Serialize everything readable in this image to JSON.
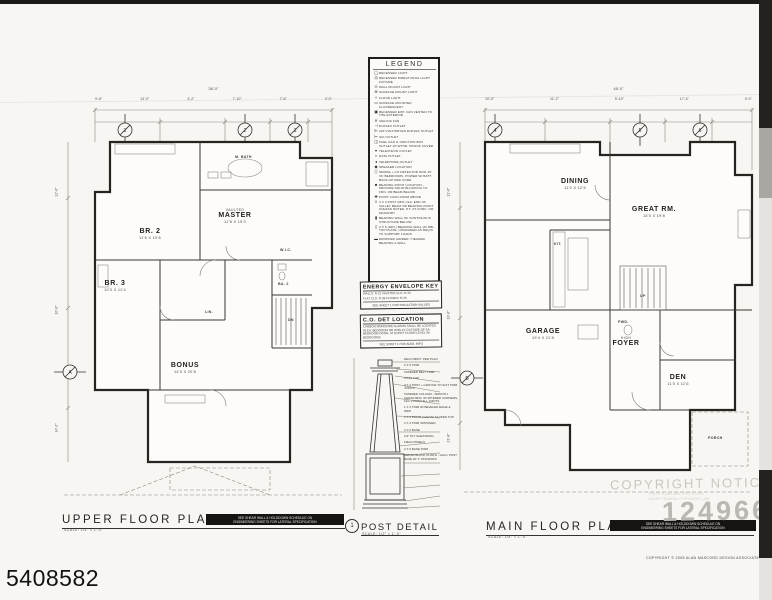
{
  "page": {
    "photo_id": "5408582",
    "watermark_notice": "COPYRIGHT NOTICE",
    "watermark_sub1": "THESE PLANS ARE PROTECTED",
    "watermark_sub2": "UNDER FEDERAL COPYRIGHT LAW",
    "watermark_number": "124966",
    "copyright_line": "COPYRIGHT © 2008 ALAN MASCORD DESIGN ASSOCIATES INC."
  },
  "notices": {
    "line1": "SEE SHEAR WALL & HOLDDOWN SCHEDULE ON",
    "line2": "ENGINEERING SHEETS FOR LATERAL SPECIFICATION"
  },
  "legend": {
    "title": "LEGEND",
    "items": [
      {
        "s": "◯",
        "t": "RECESSED LIGHT"
      },
      {
        "s": "◎",
        "t": "RECESSED DIRECTIONAL LIGHT FIXTURE"
      },
      {
        "s": "⊙",
        "t": "WALL MOUNT LIGHT"
      },
      {
        "s": "⊕",
        "t": "SURFACE MOUNT LIGHT"
      },
      {
        "s": "✧",
        "t": "FLOOD LIGHT"
      },
      {
        "s": "▭",
        "t": "SURFACE MOUNTED FLUORESCENT"
      },
      {
        "s": "▣",
        "t": "RECESSED EXH. FAN VENTED TO THE EXTERIOR"
      },
      {
        "s": "✕",
        "t": "CEILING FAN"
      },
      {
        "s": "⊣",
        "t": "DUPLEX OUTLET"
      },
      {
        "s": "⊫",
        "t": "220 VOLT/DRYER DUPLEX OUTLET"
      },
      {
        "s": "⊢",
        "t": "GFI OUTLET"
      },
      {
        "s": "◫",
        "t": "FUEL GAS & JUNCTION BOX OUTLET W/ WTHR. PROOF COVER"
      },
      {
        "s": "▾",
        "t": "TELEVISION OUTLET"
      },
      {
        "s": "▿",
        "t": "DATA OUTLET"
      },
      {
        "s": "◂",
        "t": "TELEPHONE OUTLET"
      },
      {
        "s": "◆",
        "t": "SPEAKER LOCATION"
      },
      {
        "s": "ⓢ",
        "t": "SMOKE + CO DETECTOR W/IN 15' OF BEDROOMS, POWER W/ BATT. BACK-UP PER CODE"
      },
      {
        "s": "■",
        "t": "BEARING POINT LOCATION - PROVIDE SOLID BLOCKING TO FDN. OR BEAM BELOW"
      },
      {
        "s": "✚",
        "t": "POINT LOAD FROM ABOVE"
      },
      {
        "s": "‖",
        "t": "4 X 4 POST (MIN.) EA. END OF VALLEY BEAM OR BEARING POINT UNLESS NOTED, P.T. AT CONC. OR MASONRY"
      },
      {
        "s": "▮",
        "t": "BEARING WALL W/ CONTINUOUS STRUCTURE BELOW"
      },
      {
        "s": "▯",
        "t": "2 X 6 (MIN.) BEARING WALL W/ DBL. TOP PLATE, UPGRADED AS REQ'D TO SUPPORT LOADS"
      },
      {
        "s": "▬",
        "t": "DROPPED GIRDER / HEADER BEARING A WALL"
      }
    ]
  },
  "energy_key": {
    "title": "ENERGY ENVELOPE KEY",
    "line1": "WALLS: R-21      VAULTED CLG: R-30",
    "line2": "FLAT CLG: R-38   FLOORS: R-25",
    "footer": "SEE SHEET 1 FOR INSULATION VALUES"
  },
  "co_det": {
    "title": "C.O. DET LOCATION",
    "body": "CARBON MONOXIDE ALARMS SHALL BE LOCATED IN EA. BEDROOM OR W/IN 15' OUTSIDE OF EA. BEDROOM DOOR, AT EVERY FLOOR LEVEL W/ BEDROOMS",
    "footer": "SEE SHEET 1 FOR ADD'L INFO"
  },
  "post_detail": {
    "bubble": "1",
    "title": "POST DETAIL",
    "scale": "SCALE: 1/2\" = 1'-0\"",
    "callouts": [
      "DECO BRKT. PER PLAN",
      "2 X 6 TRIM",
      "TAPERED BELT TRIM",
      "POST CAP",
      "4 X 4 POST + GROOVE TO SUIT TRIM JOINTS",
      "TAPERED COLUMN - SMOOTH CEDAR BDS. W/ MITERED CORNERS, FILL + PAINT ALL JOINTS",
      "1 X 4 TRIM W/ BEVELED EDGE & DRIP",
      "2 X 6 PLINTH CAP W/ SLOPED TOP",
      "2 X 4 TRIM 'APRONED'",
      "2 X 6 BASE",
      "1/2\" PLY SHEATHING",
      "FIELD PANELS",
      "2 X 6 BASE TRIM",
      "CEDAR BLOCK PLINTH - GALV. POST BASE W/ 1\" STANDOFF"
    ]
  },
  "upper_plan": {
    "title": "UPPER FLOOR PLAN",
    "scale": "SCALE: 1/4\" = 1'-0\"",
    "overall_dim": "38'-0\"",
    "dims_top": [
      "9'-6\"",
      "13'-0\"",
      "4'-2\"",
      "7'-10\"",
      "7'-6\"",
      "3'-0\""
    ],
    "dims_left": [
      "12'-6\"",
      "10'-0\"",
      "14'-2\""
    ],
    "grid_bubbles": [
      "1",
      "2",
      "3"
    ],
    "side_bubble": "A",
    "rooms": {
      "br2": {
        "name": "BR. 2",
        "dims": "11'6 X 10'8"
      },
      "master": {
        "sub": "VAULTED",
        "name": "MASTER",
        "dims": "12'6 X 15'0"
      },
      "br3": {
        "name": "BR. 3",
        "dims": "10'0 X 11'4"
      },
      "bonus": {
        "name": "BONUS",
        "dims": "14'0 X 20'8"
      }
    },
    "small_labels": {
      "mba": "M. BATH",
      "wic": "W.I.C.",
      "ba2": "BA. 2",
      "lin": "LIN.",
      "dn": "DN"
    }
  },
  "main_plan": {
    "title": "MAIN FLOOR PLAN",
    "scale": "SCALE: 1/4\" = 1'-0\"",
    "overall_dim": "48'-0\"",
    "dims_top": [
      "10'-0\"",
      "11'-2\"",
      "5'-10\"",
      "17'-4\"",
      "9'-0\""
    ],
    "dims_left": [
      "11'-0\"",
      "13'-6\"",
      "21'-8\""
    ],
    "grid_bubbles": [
      "4",
      "5",
      "6"
    ],
    "side_bubble": "B",
    "inner_bubble": "C",
    "rooms": {
      "dining": {
        "name": "DINING",
        "dims": "11'0 X 12'6"
      },
      "great": {
        "name": "GREAT RM.",
        "dims": "15'0 X 19'8"
      },
      "garage": {
        "name": "GARAGE",
        "dims": "19'4 X 21'8"
      },
      "foyer": {
        "sub": "HIGH",
        "name": "FOYER",
        "dims": ""
      },
      "den": {
        "name": "DEN",
        "dims": "11'0 X 11'6"
      }
    },
    "small_labels": {
      "kit": "KIT.",
      "pwd": "PWD.",
      "up": "UP",
      "porch": "PORCH"
    }
  }
}
